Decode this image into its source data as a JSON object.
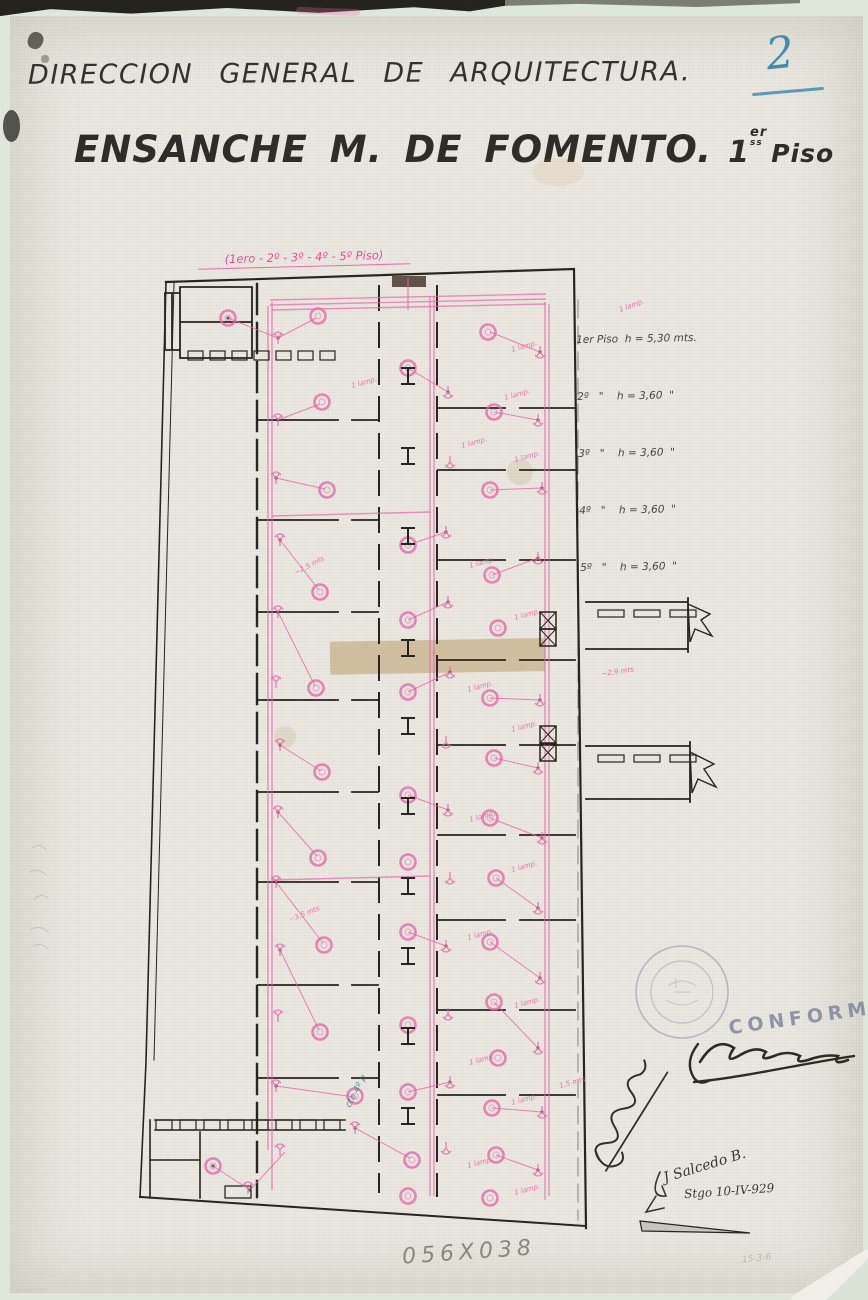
{
  "page": {
    "number": "2"
  },
  "header": {
    "department": "DIRECCION GENERAL DE ARQUITECTURA.",
    "title": "ENSANCHE M. DE FOMENTO.",
    "floor_num": "1",
    "floor_sup": "er",
    "floor_sub": "ss",
    "floor_word": "Piso"
  },
  "plan_note": "(1ero - 2º - 3º - 4º - 5º Piso)",
  "legend": {
    "rows": [
      "1er Piso  h = 5,30 mts.",
      "2º   \"    h = 3,60  \"",
      "3º   \"    h = 3,60  \"",
      "4º   \"    h = 3,60  \"",
      "5º   \"    h = 3,60  \""
    ]
  },
  "approval": {
    "conforme": "CONFORME",
    "signature_name": "J Salcedo B.",
    "date": "Stgo 10-IV-929"
  },
  "footer": {
    "dimensions": "056X038",
    "corner_note": "15-3-6"
  },
  "colors": {
    "pink": "#e668ab",
    "ink": "#26251f",
    "teal": "#2e7d8c",
    "blue": "#3f8fae",
    "stamp": "#8d7fb0",
    "pencil": "#7a796e"
  },
  "plan": {
    "mains": [
      [
        272,
        302,
        272,
        1190
      ],
      [
        268,
        306,
        268,
        1150
      ],
      [
        430,
        296,
        430,
        1196
      ],
      [
        434,
        296,
        434,
        1196
      ],
      [
        545,
        302,
        545,
        1200
      ],
      [
        549,
        304,
        549,
        1196
      ],
      [
        270,
        300,
        546,
        294
      ],
      [
        270,
        305,
        546,
        299
      ],
      [
        272,
        310,
        546,
        304
      ],
      [
        408,
        278,
        408,
        310
      ],
      [
        272,
        516,
        430,
        512
      ],
      [
        272,
        880,
        430,
        876
      ]
    ],
    "lamps": [
      [
        228,
        318
      ],
      [
        318,
        316
      ],
      [
        322,
        402
      ],
      [
        327,
        490
      ],
      [
        320,
        592
      ],
      [
        316,
        688
      ],
      [
        322,
        772
      ],
      [
        318,
        858
      ],
      [
        324,
        945
      ],
      [
        320,
        1032
      ],
      [
        213,
        1166
      ],
      [
        355,
        1096
      ],
      [
        408,
        368
      ],
      [
        408,
        545
      ],
      [
        408,
        620
      ],
      [
        408,
        692
      ],
      [
        408,
        795
      ],
      [
        408,
        862
      ],
      [
        408,
        932
      ],
      [
        408,
        1025
      ],
      [
        408,
        1092
      ],
      [
        412,
        1160
      ],
      [
        408,
        1196
      ],
      [
        488,
        332
      ],
      [
        494,
        412
      ],
      [
        490,
        490
      ],
      [
        492,
        575
      ],
      [
        498,
        628
      ],
      [
        490,
        698
      ],
      [
        494,
        758
      ],
      [
        490,
        818
      ],
      [
        496,
        878
      ],
      [
        490,
        942
      ],
      [
        494,
        1002
      ],
      [
        498,
        1058
      ],
      [
        492,
        1108
      ],
      [
        496,
        1155
      ],
      [
        490,
        1198
      ]
    ],
    "switches": [
      [
        278,
        338,
        0
      ],
      [
        278,
        420,
        0
      ],
      [
        276,
        478,
        0
      ],
      [
        280,
        540,
        0
      ],
      [
        278,
        612,
        0
      ],
      [
        276,
        682,
        0
      ],
      [
        280,
        745,
        0
      ],
      [
        278,
        812,
        0
      ],
      [
        276,
        882,
        0
      ],
      [
        280,
        950,
        0
      ],
      [
        278,
        1016,
        0
      ],
      [
        276,
        1086,
        0
      ],
      [
        280,
        1150,
        0
      ],
      [
        448,
        392,
        180
      ],
      [
        450,
        462,
        180
      ],
      [
        446,
        532,
        180
      ],
      [
        448,
        602,
        180
      ],
      [
        450,
        672,
        180
      ],
      [
        446,
        742,
        180
      ],
      [
        448,
        810,
        180
      ],
      [
        450,
        878,
        180
      ],
      [
        446,
        946,
        180
      ],
      [
        448,
        1014,
        180
      ],
      [
        450,
        1082,
        180
      ],
      [
        446,
        1148,
        180
      ],
      [
        540,
        352,
        180
      ],
      [
        538,
        420,
        180
      ],
      [
        542,
        488,
        180
      ],
      [
        538,
        558,
        180
      ],
      [
        540,
        700,
        180
      ],
      [
        538,
        768,
        180
      ],
      [
        542,
        838,
        180
      ],
      [
        538,
        908,
        180
      ],
      [
        540,
        978,
        180
      ],
      [
        538,
        1048,
        180
      ],
      [
        542,
        1112,
        180
      ],
      [
        538,
        1170,
        180
      ],
      [
        248,
        1188,
        0
      ],
      [
        355,
        1128,
        0
      ]
    ],
    "wires": [
      [
        278,
        338,
        316,
        318
      ],
      [
        278,
        420,
        320,
        404
      ],
      [
        276,
        478,
        325,
        489
      ],
      [
        280,
        540,
        319,
        590
      ],
      [
        278,
        612,
        315,
        686
      ],
      [
        280,
        745,
        321,
        771
      ],
      [
        278,
        812,
        317,
        856
      ],
      [
        276,
        882,
        323,
        943
      ],
      [
        280,
        950,
        319,
        1030
      ],
      [
        276,
        1086,
        354,
        1097
      ],
      [
        448,
        392,
        408,
        368
      ],
      [
        446,
        532,
        408,
        545
      ],
      [
        448,
        602,
        408,
        620
      ],
      [
        450,
        672,
        408,
        692
      ],
      [
        448,
        810,
        408,
        795
      ],
      [
        446,
        946,
        408,
        932
      ],
      [
        450,
        1082,
        408,
        1092
      ],
      [
        540,
        352,
        490,
        332
      ],
      [
        538,
        420,
        494,
        412
      ],
      [
        542,
        488,
        490,
        490
      ],
      [
        538,
        558,
        492,
        575
      ],
      [
        540,
        700,
        490,
        698
      ],
      [
        538,
        768,
        494,
        758
      ],
      [
        542,
        838,
        490,
        818
      ],
      [
        538,
        908,
        496,
        878
      ],
      [
        540,
        978,
        490,
        942
      ],
      [
        538,
        1048,
        494,
        1002
      ],
      [
        542,
        1112,
        492,
        1108
      ],
      [
        538,
        1170,
        496,
        1155
      ],
      [
        213,
        1166,
        250,
        1190
      ],
      [
        250,
        1190,
        285,
        1152
      ],
      [
        355,
        1128,
        410,
        1158
      ],
      [
        228,
        318,
        278,
        338
      ]
    ],
    "labels": [
      {
        "x": 512,
        "y": 352,
        "t": "1 lamp."
      },
      {
        "x": 505,
        "y": 400,
        "t": "1 lamp."
      },
      {
        "x": 462,
        "y": 448,
        "t": "1 lamp."
      },
      {
        "x": 515,
        "y": 462,
        "t": "1 lamp."
      },
      {
        "x": 352,
        "y": 388,
        "t": "1 lamp."
      },
      {
        "x": 470,
        "y": 568,
        "t": "1 lamp."
      },
      {
        "x": 515,
        "y": 620,
        "t": "1 lamp."
      },
      {
        "x": 468,
        "y": 692,
        "t": "1 lamp."
      },
      {
        "x": 512,
        "y": 732,
        "t": "1 lamp."
      },
      {
        "x": 470,
        "y": 822,
        "t": "1 lamp."
      },
      {
        "x": 512,
        "y": 872,
        "t": "1 lamp."
      },
      {
        "x": 468,
        "y": 940,
        "t": "1 lamp."
      },
      {
        "x": 515,
        "y": 1008,
        "t": "1 lamp."
      },
      {
        "x": 470,
        "y": 1065,
        "t": "1 lamp."
      },
      {
        "x": 512,
        "y": 1105,
        "t": "1 lamp."
      },
      {
        "x": 468,
        "y": 1168,
        "t": "1 lamp."
      },
      {
        "x": 515,
        "y": 1195,
        "t": "1 lamp."
      },
      {
        "x": 620,
        "y": 312,
        "t": "1 lamp.",
        "r": -20
      },
      {
        "x": 296,
        "y": 575,
        "t": "~2,5 mts",
        "r": -28
      },
      {
        "x": 290,
        "y": 922,
        "t": "~3,5 mts",
        "r": -22
      },
      {
        "x": 602,
        "y": 676,
        "t": "~2,9 mts",
        "r": -8
      },
      {
        "x": 560,
        "y": 1088,
        "t": "1,5 mts",
        "r": -15
      }
    ],
    "notes": [
      {
        "x": 350,
        "y": 1108,
        "t": "cto 4º p",
        "r": -62
      }
    ],
    "columns": [
      368,
      448,
      528,
      640,
      718,
      798,
      878,
      948,
      1028,
      1108
    ],
    "shafts": [
      [
        540,
        612
      ],
      [
        540,
        629
      ],
      [
        540,
        726
      ],
      [
        540,
        744
      ]
    ],
    "tickrows": [
      {
        "x0": 188,
        "y": 351,
        "step": 22,
        "w": 15,
        "h": 9,
        "n": 7
      },
      {
        "x0": 156,
        "y": 1120,
        "step": 24,
        "w": 16,
        "h": 10,
        "n": 8
      },
      {
        "x0": 598,
        "y": 610,
        "step": 36,
        "w": 26,
        "h": 7,
        "n": 3
      },
      {
        "x0": 598,
        "y": 755,
        "step": 36,
        "w": 26,
        "h": 7,
        "n": 3
      }
    ]
  }
}
